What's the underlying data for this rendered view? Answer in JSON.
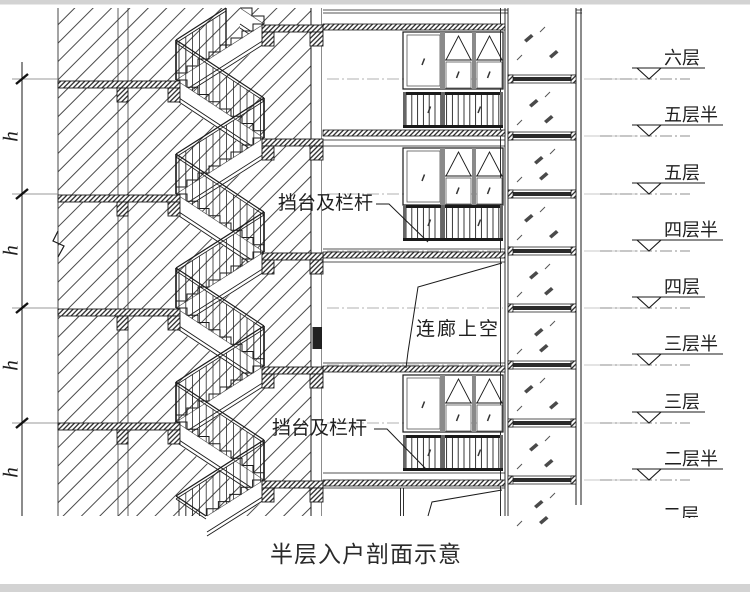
{
  "drawing_title": "半层入户剖面示意",
  "annotations": {
    "railing_label_upper": "挡台及栏杆",
    "railing_label_lower": "挡台及栏杆",
    "corridor_void_label": "连廊上空",
    "floor_height_label": "h"
  },
  "level_markers": [
    {
      "label": "六层",
      "y": 79,
      "clipped": false
    },
    {
      "label": "五层半",
      "y": 136,
      "clipped": false
    },
    {
      "label": "五层",
      "y": 194,
      "clipped": false
    },
    {
      "label": "四层半",
      "y": 251,
      "clipped": false
    },
    {
      "label": "四层",
      "y": 308,
      "clipped": false
    },
    {
      "label": "三层半",
      "y": 365,
      "clipped": false
    },
    {
      "label": "三层",
      "y": 423,
      "clipped": false
    },
    {
      "label": "二层半",
      "y": 480,
      "clipped": false
    },
    {
      "label": "二层",
      "y": 537,
      "clipped": true
    }
  ],
  "colors": {
    "line": "#1a1a1a",
    "hatch": "#4a4a4a",
    "faint": "#b8b8b8",
    "centerline": "#999999",
    "frame_gray": "#8a8a8a",
    "page_bar": "#d3d3d3",
    "ext_line": "#777777"
  }
}
